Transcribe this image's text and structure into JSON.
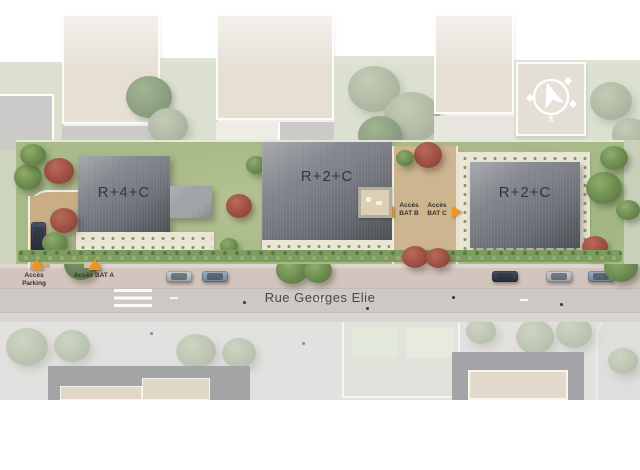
{
  "site_plan": {
    "buildings": [
      {
        "id": "bat-a",
        "label": "R+4+C"
      },
      {
        "id": "bat-b",
        "label": "R+2+C"
      },
      {
        "id": "bat-c",
        "label": "R+2+C"
      }
    ],
    "access": {
      "parking": "Accès Parking",
      "bat_a": "Accès BAT A",
      "bat_b": "Accès BAT B",
      "bat_c": "Accès BAT C"
    },
    "street": "Rue Georges Elie",
    "compass_label": "S",
    "icons": {
      "compass": "compass-south-arrow",
      "access_marker": "orange-triangle",
      "access_arrow": "orange-arrow"
    },
    "colors": {
      "roof": "#6e7178",
      "grass": "#a6b986",
      "path": "#c9ad85",
      "road": "#cbc8c5",
      "accent_orange": "#f0941f"
    }
  }
}
